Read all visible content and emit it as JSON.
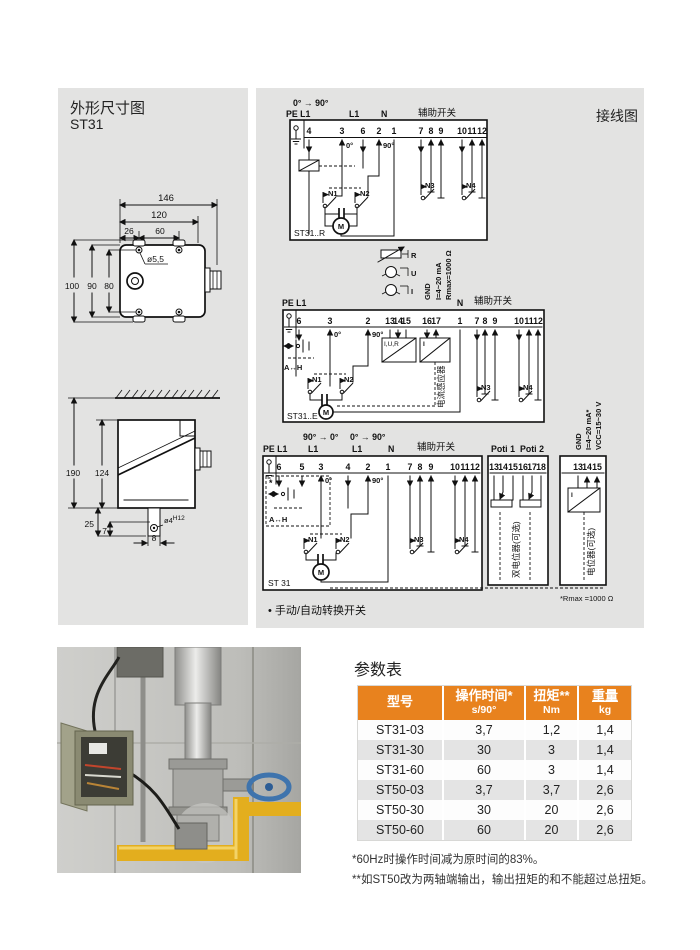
{
  "colors": {
    "accent_orange": "#E8821E",
    "panel_gray": "#E3E3E2",
    "row_alt": "#E4E4E4",
    "pipe_yellow": "#E3AE1E",
    "wheel_blue": "#3F74AD"
  },
  "dim_section": {
    "title": "外形尺寸图",
    "model": "ST31"
  },
  "wiring_section": {
    "title": "接线图"
  },
  "dim_top": {
    "d146": "146",
    "d120": "120",
    "d26": "26",
    "d60": "60",
    "hole": "ø5,5",
    "d100": "100",
    "d90": "90",
    "d80": "80"
  },
  "dim_side": {
    "d190": "190",
    "d124": "124",
    "d25": "25",
    "d7": "7",
    "d8": "8",
    "shaft": "ø4",
    "shaft_tol": "H12"
  },
  "d1": {
    "angle": "0° → 90°",
    "pe": "PE L1",
    "l1": "L1",
    "n": "N",
    "aux": "辅助开关",
    "deg0": "0°",
    "deg90": "90°",
    "n1": "N1",
    "n2": "N2",
    "n3": "N3",
    "n4": "N4",
    "m": "M",
    "label": "ST31..R",
    "t": [
      "4",
      "3",
      "6",
      "2",
      "1",
      "7",
      "8",
      "9",
      "10",
      "11",
      "12"
    ]
  },
  "d2": {
    "r": "R",
    "u": "U",
    "i": "I",
    "gnd": "GND",
    "ima": "I=4~20 mA",
    "rmax": "Rmax=1000 Ω",
    "pe": "PE L1",
    "n": "N",
    "aux": "辅助开关",
    "deg0": "0°",
    "deg90": "90°",
    "ah": "A↔H",
    "iur": "I,U,R",
    "ibox": "I",
    "sensor": "电流感应器",
    "n1": "N1",
    "n2": "N2",
    "n3": "N3",
    "n4": "N4",
    "m": "M",
    "label": "ST31..E",
    "t": [
      "6",
      "3",
      "2",
      "13",
      "14",
      "15",
      "16",
      "17",
      "1",
      "7",
      "8",
      "9",
      "10",
      "11",
      "12"
    ]
  },
  "d3": {
    "angle_l": "90° → 0°",
    "angle_r": "0° → 90°",
    "pe": "PE L1",
    "l1a": "L1",
    "l1b": "L1",
    "n": "N",
    "aux": "辅助开关",
    "poti1": "Poti 1",
    "poti2": "Poti 2",
    "gnd": "GND",
    "ima": "I=4~20 mA*",
    "vcc": "VCC=15~30 V",
    "star": "*",
    "ah": "A↔H",
    "deg0": "0°",
    "deg90": "90°",
    "n1": "N1",
    "n2": "N2",
    "n3": "N3",
    "n4": "N4",
    "m": "M",
    "label": "ST 31",
    "dual": "双电位器(可选)",
    "single": "电位器(可选)",
    "ibox": "I",
    "rnote": "*Rmax =1000 Ω",
    "note": "• 手动/自动转换开关",
    "t": [
      "6",
      "5",
      "3",
      "4",
      "2",
      "1",
      "7",
      "8",
      "9",
      "10",
      "11",
      "12"
    ],
    "tp": [
      "13",
      "14",
      "15",
      "16",
      "17",
      "18"
    ],
    "to": [
      "13",
      "14",
      "15"
    ]
  },
  "table": {
    "title": "参数表",
    "headers": [
      {
        "l1": "型号",
        "l2": ""
      },
      {
        "l1": "操作时间*",
        "l2": "s/90°"
      },
      {
        "l1": "扭矩**",
        "l2": "Nm"
      },
      {
        "l1": "重量",
        "l2": "kg"
      }
    ],
    "rows": [
      [
        "ST31-03",
        "3,7",
        "1,2",
        "1,4"
      ],
      [
        "ST31-30",
        "30",
        "3",
        "1,4"
      ],
      [
        "ST31-60",
        "60",
        "3",
        "1,4"
      ],
      [
        "ST50-03",
        "3,7",
        "3,7",
        "2,6"
      ],
      [
        "ST50-30",
        "30",
        "20",
        "2,6"
      ],
      [
        "ST50-60",
        "60",
        "20",
        "2,6"
      ]
    ],
    "footnote1": "*60Hz时操作时间减为原时间的83%。",
    "footnote2": "**如ST50改为两轴端输出，输出扭矩的和不能超过总扭矩。"
  }
}
